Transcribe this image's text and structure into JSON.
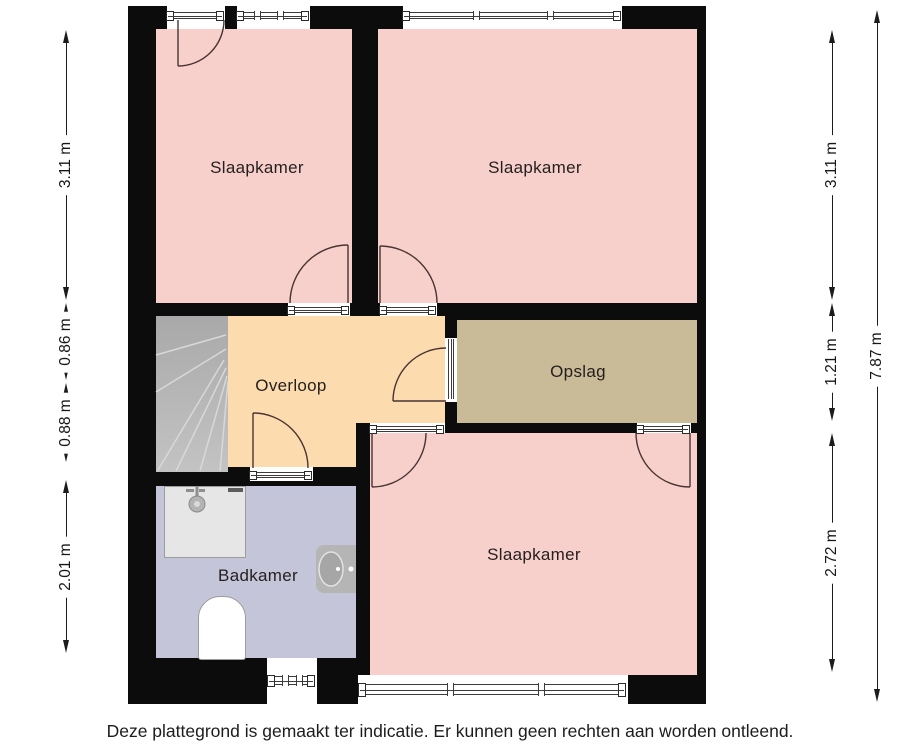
{
  "rooms": [
    {
      "name": "slaapkamer-top-left",
      "label": "Slaapkamer"
    },
    {
      "name": "slaapkamer-top-right",
      "label": "Slaapkamer"
    },
    {
      "name": "overloop",
      "label": "Overloop"
    },
    {
      "name": "opslag",
      "label": "Opslag"
    },
    {
      "name": "badkamer",
      "label": "Badkamer"
    },
    {
      "name": "slaapkamer-bottom",
      "label": "Slaapkamer"
    }
  ],
  "dimensions": {
    "left": [
      "3.11 m",
      "0.86 m",
      "0.88 m",
      "2.01 m"
    ],
    "right": [
      "3.11 m",
      "1.21 m",
      "2.72 m"
    ],
    "right_total": "7.87 m"
  },
  "disclaimer": "Deze plattegrond is gemaakt ter indicatie. Er kunnen geen rechten aan worden ontleend.",
  "colors": {
    "wall": "#0c0c0c",
    "bedroom": "#f8d0cb",
    "landing": "#fcdcae",
    "storage": "#c9ba98",
    "bathroom": "#c4c5d8",
    "stairs": "#b9b9b9",
    "door-line": "#4a3333",
    "frame-line": "#3c3c3c"
  }
}
